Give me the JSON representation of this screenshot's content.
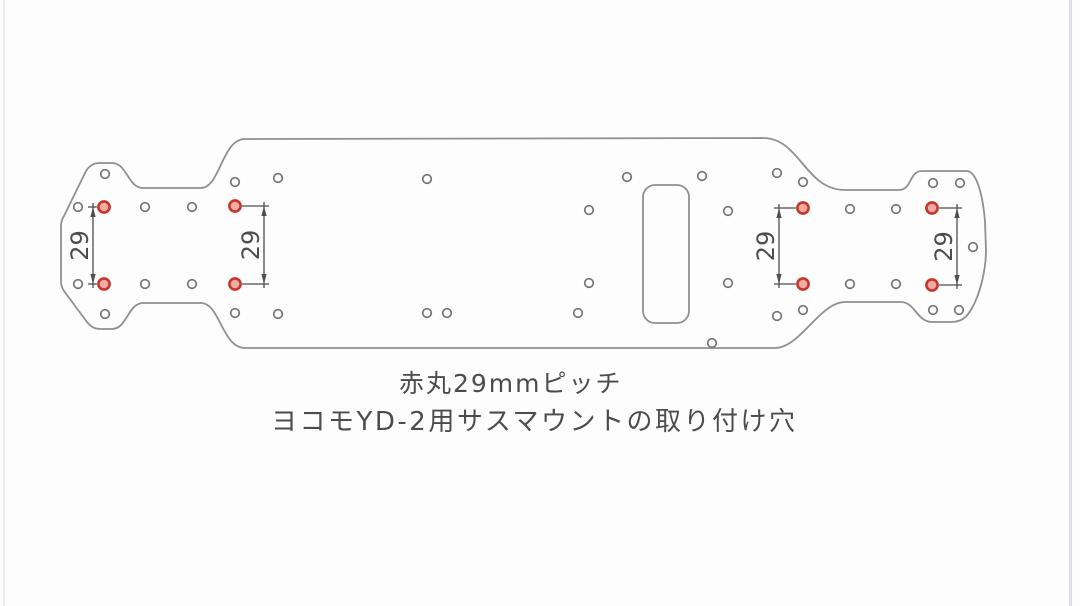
{
  "page": {
    "background": "#fdfdfe",
    "left_edge_color": "#eaeaf1",
    "right_edge_color": "#dfdfe8"
  },
  "captions": {
    "line1": "赤丸29mmピッチ",
    "line2": "ヨコモYD-2用サスマウントの取り付け穴"
  },
  "drawing": {
    "outline_color": "#8f9091",
    "hole_stroke": "#747576",
    "dim_color": "#4d4d4d",
    "red_hole_stroke": "#c4382c",
    "red_hole_fill": "#f1aba3",
    "small_hole_radius": 4.3,
    "red_hole_radius": 5.6,
    "outline_path": "M 100,163 L 112,163 C 127,163 128,188 143,188 L 201,188 C 220,188 222,139 245,139 L 763,138 C 800,138 805,190 845,190 L 899,190 C 912,190 909,171 922,171 L 967,171 C 977,172 983,196 985,222 L 986,250 C 986,272 979,296 972,308 C 967,317 962,322 951,322 L 932,322 C 917,322 915,302 901,302 L 845,302 C 820,302 800,348 775,348 L 245,348 C 222,348 220,303 201,303 L 143,303 C 128,303 127,329 112,329 L 100,329 C 94,329 90,326 87,322 L 64,291 C 62,288 61,285 61,281 L 61,226 C 61,222 62,219 64,216 L 86,171 C 90,165 94,163 100,163 Z",
    "slot": {
      "x": 643,
      "y": 185,
      "width": 46,
      "height": 138,
      "radius": 12
    },
    "holes_small": [
      [
        105,
        174
      ],
      [
        78,
        207
      ],
      [
        78,
        284
      ],
      [
        105,
        314
      ],
      [
        145,
        207
      ],
      [
        192,
        207
      ],
      [
        145,
        284
      ],
      [
        192,
        284
      ],
      [
        235,
        182
      ],
      [
        235,
        313
      ],
      [
        278,
        178
      ],
      [
        278,
        314
      ],
      [
        427,
        179
      ],
      [
        427,
        313
      ],
      [
        447,
        313
      ],
      [
        589,
        210
      ],
      [
        589,
        283
      ],
      [
        578,
        313
      ],
      [
        627,
        177
      ],
      [
        702,
        176
      ],
      [
        728,
        211
      ],
      [
        728,
        283
      ],
      [
        712,
        343
      ],
      [
        777,
        173
      ],
      [
        803,
        182
      ],
      [
        803,
        310
      ],
      [
        777,
        316
      ],
      [
        850,
        209
      ],
      [
        896,
        209
      ],
      [
        850,
        284
      ],
      [
        896,
        284
      ],
      [
        933,
        183
      ],
      [
        960,
        183
      ],
      [
        973,
        247
      ],
      [
        933,
        310
      ],
      [
        959,
        310
      ]
    ],
    "holes_red": [
      [
        104,
        207
      ],
      [
        104,
        284
      ],
      [
        235,
        206
      ],
      [
        235,
        284
      ],
      [
        803,
        208
      ],
      [
        803,
        284
      ],
      [
        932,
        208
      ],
      [
        932,
        285
      ]
    ],
    "dimensions": [
      {
        "label": "29",
        "line_x": 93,
        "y1": 207,
        "y2": 284,
        "hole_x": 104,
        "label_cx": 80
      },
      {
        "label": "29",
        "line_x": 264,
        "y1": 206,
        "y2": 284,
        "hole_x": 235,
        "label_cx": 251
      },
      {
        "label": "29",
        "line_x": 779,
        "y1": 208,
        "y2": 284,
        "hole_x": 803,
        "label_cx": 766
      },
      {
        "label": "29",
        "line_x": 957,
        "y1": 208,
        "y2": 285,
        "hole_x": 932,
        "label_cx": 944
      }
    ]
  }
}
